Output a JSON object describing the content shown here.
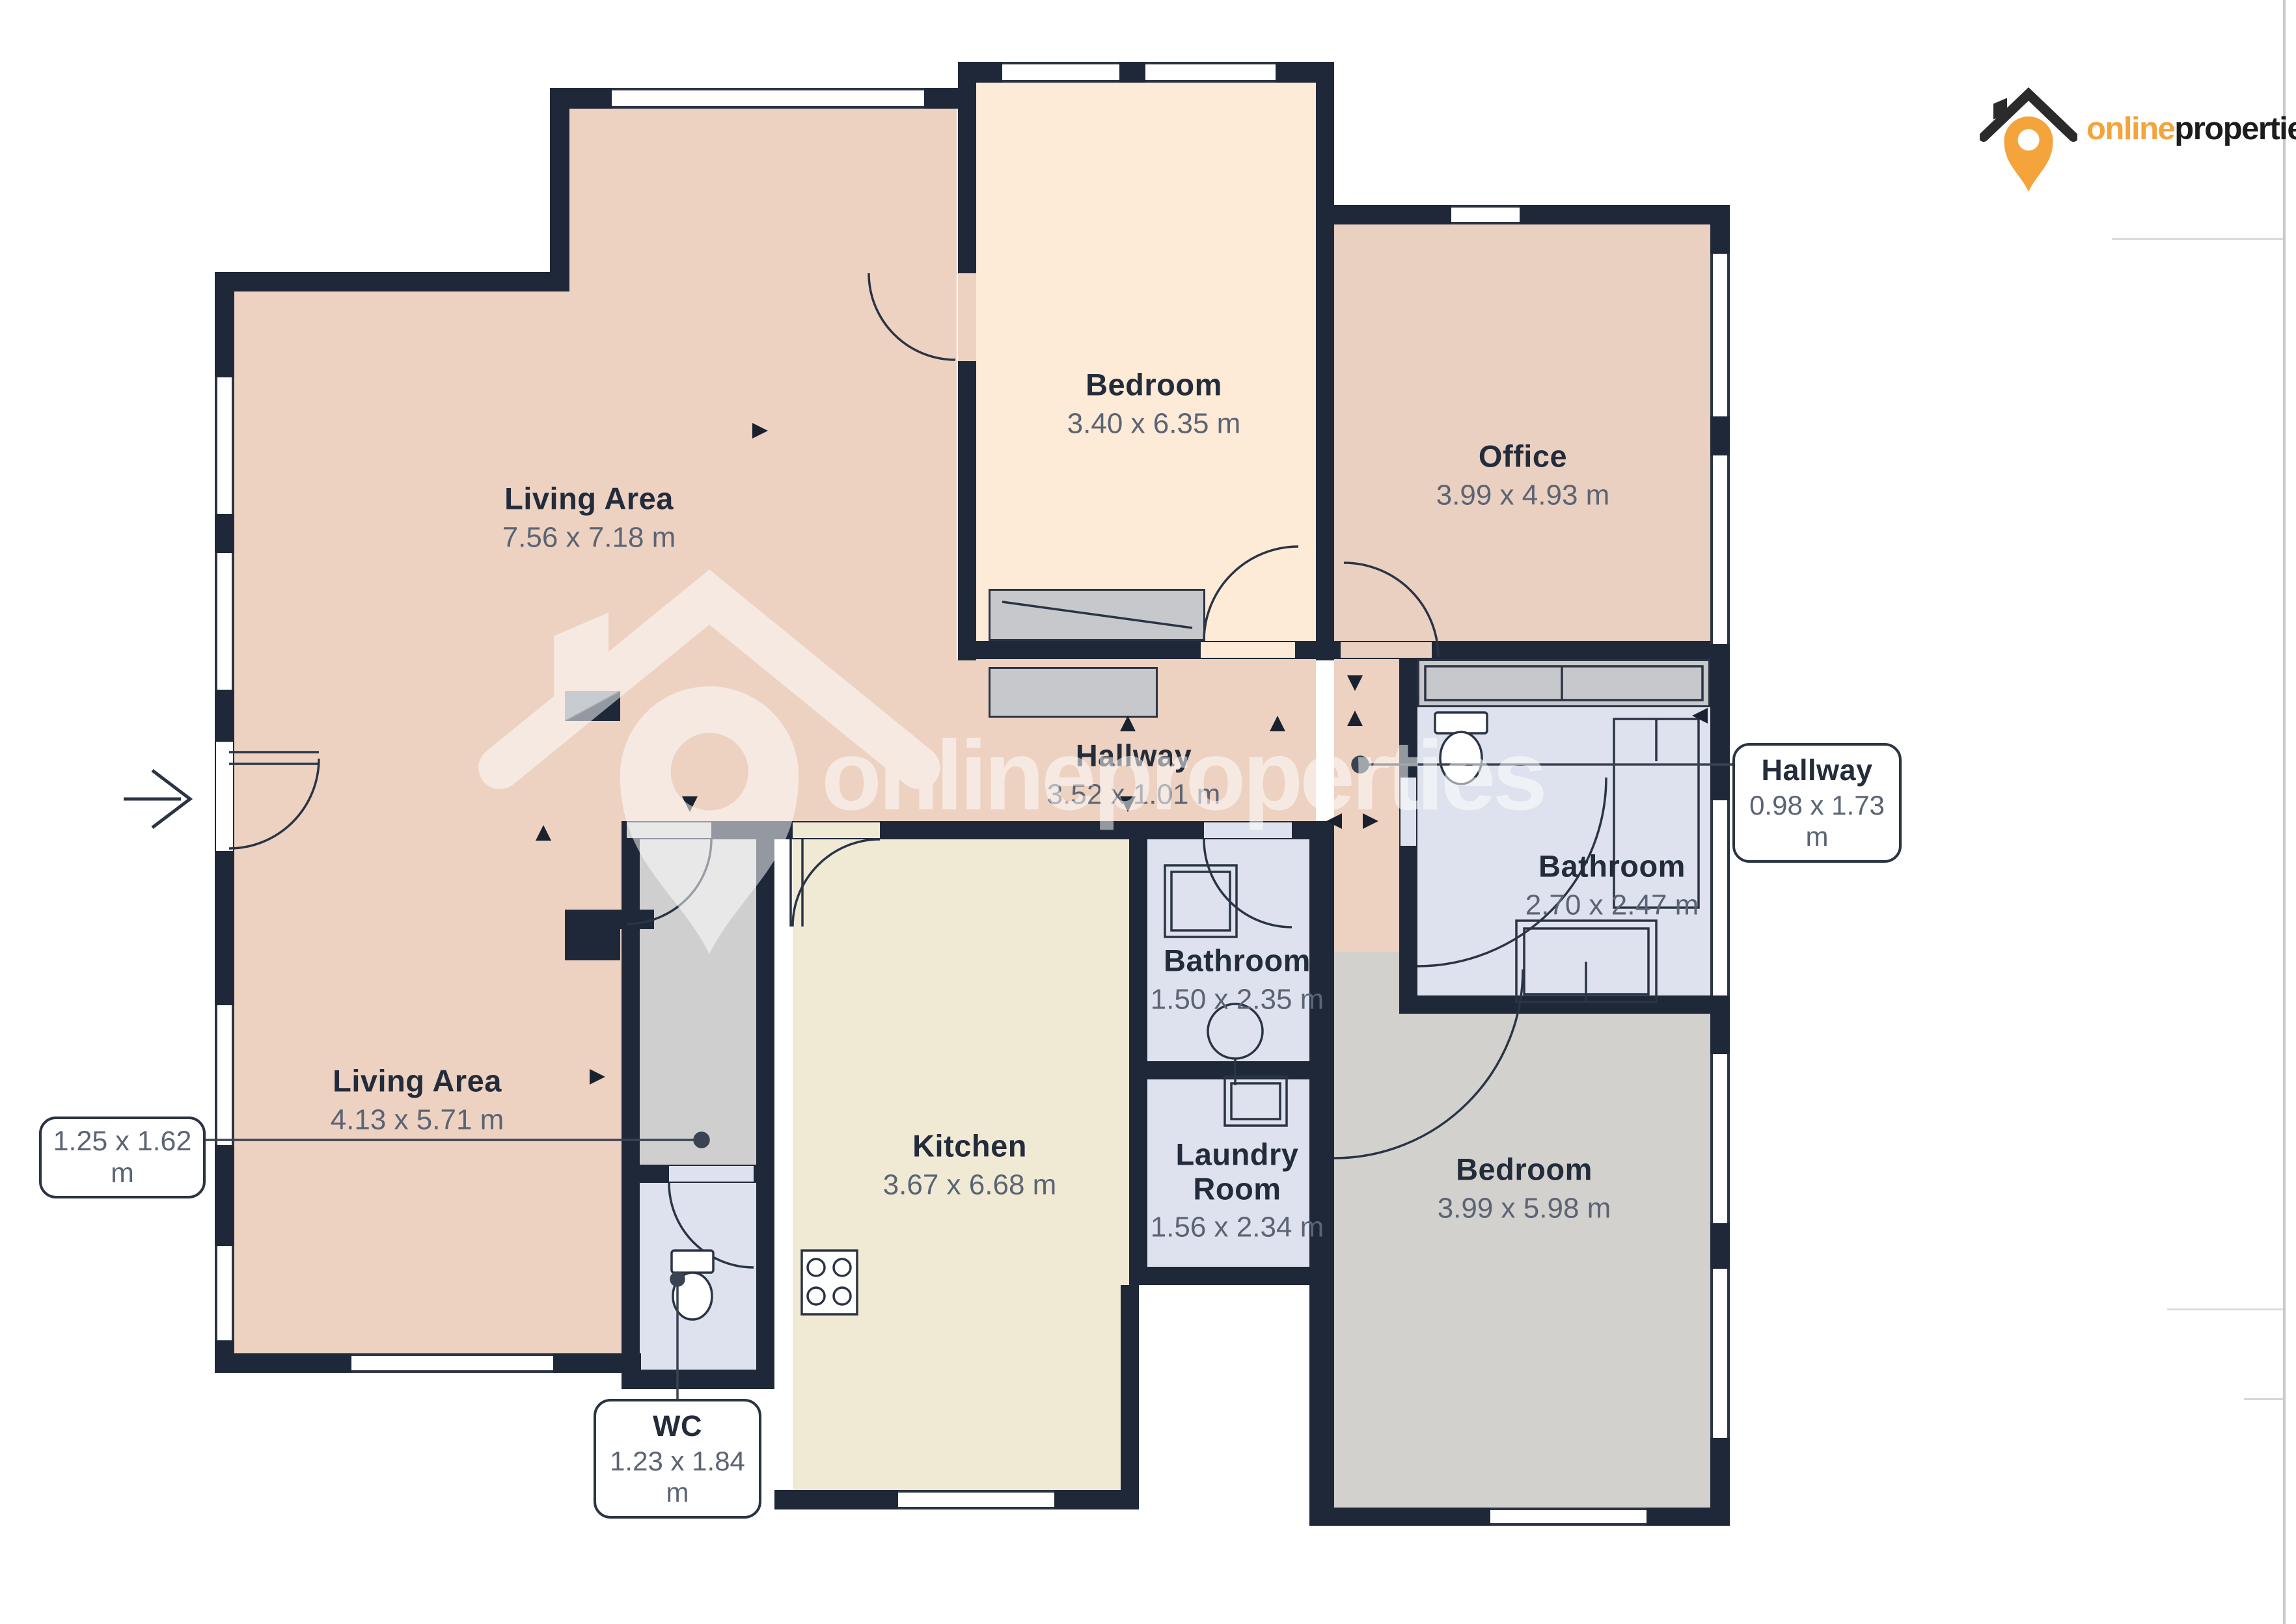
{
  "logo": {
    "brand_online": "online",
    "brand_properties": "properties"
  },
  "watermark": {
    "brand_online": "online",
    "brand_properties": "properties"
  },
  "colors": {
    "wall": "#1f2838",
    "living": "#edd2c2",
    "bedroom_top": "#fdead7",
    "office": "#e9d0c1",
    "kitchen": "#f0ead5",
    "bathroom": "#dde2ee",
    "bedroom_bottom": "#d3d1cd",
    "corridor": "#cfcfcf",
    "accent_orange": "#f4a43b",
    "label_text": "#232c3b",
    "dims_text": "#5b6474"
  },
  "rooms": {
    "living_top": {
      "name": "Living Area",
      "dims": "7.56 x 7.18 m"
    },
    "bedroom_top": {
      "name": "Bedroom",
      "dims": "3.40 x 6.35 m"
    },
    "office": {
      "name": "Office",
      "dims": "3.99 x 4.93 m"
    },
    "hallway": {
      "name": "Hallway",
      "dims": "3.52 x 1.01 m"
    },
    "bathroom_right": {
      "name": "Bathroom",
      "dims": "2.70 x 2.47 m"
    },
    "bathroom_mid": {
      "name": "Bathroom",
      "dims": "1.50 x 2.35 m"
    },
    "living_bottom": {
      "name": "Living Area",
      "dims": "4.13 x 5.71 m"
    },
    "kitchen": {
      "name": "Kitchen",
      "dims": "3.67 x 6.68 m"
    },
    "laundry": {
      "name": "Laundry Room",
      "dims": "1.56 x 2.34 m"
    },
    "bedroom_bottom": {
      "name": "Bedroom",
      "dims": "3.99 x 5.98 m"
    }
  },
  "callouts": {
    "hallway_side": {
      "name": "Hallway",
      "dims": "0.98 x 1.73 m"
    },
    "closet": {
      "dims": "1.25 x 1.62 m"
    },
    "wc": {
      "name": "WC",
      "dims": "1.23 x 1.84 m"
    }
  }
}
